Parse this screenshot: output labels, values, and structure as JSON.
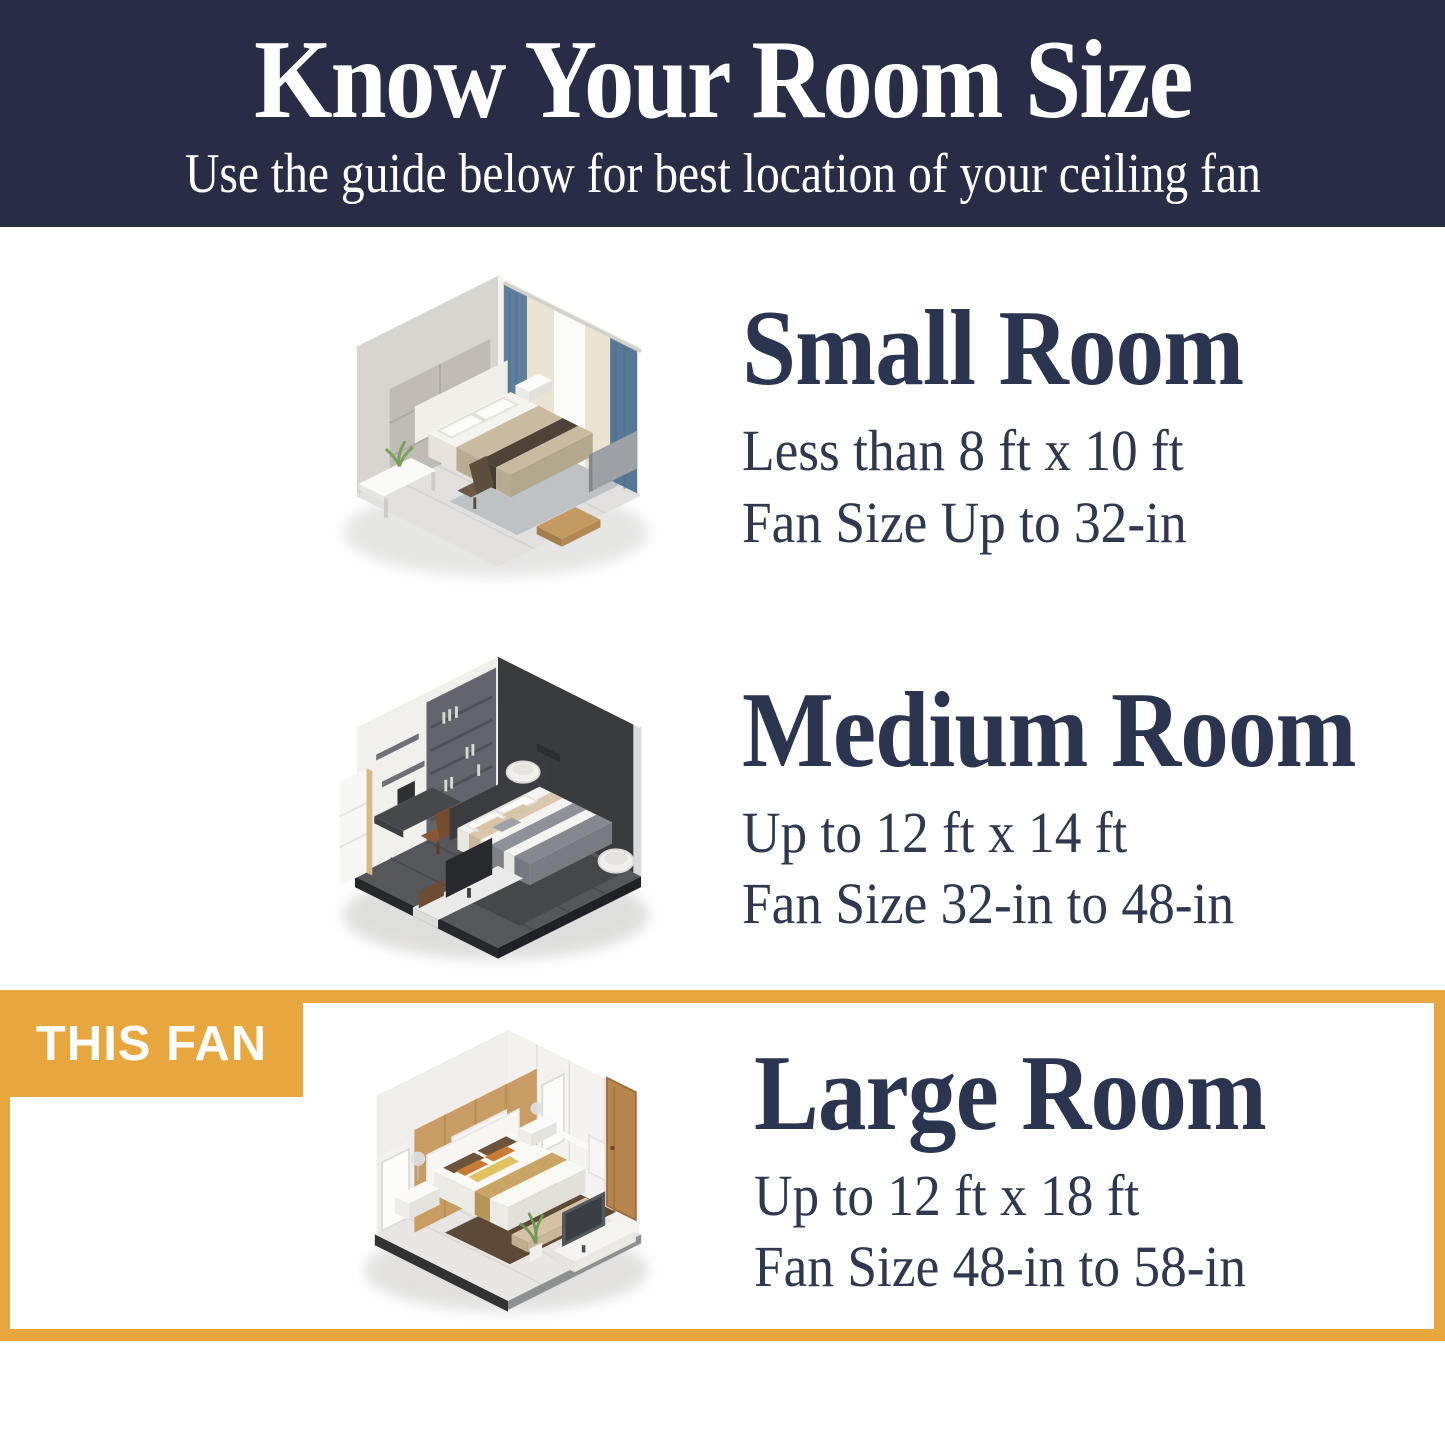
{
  "header": {
    "title": "Know Your Room Size",
    "subtitle": "Use the guide below for best location of your ceiling fan"
  },
  "sections": [
    {
      "name": "Small Room",
      "size_range": "Less than 8 ft x 10 ft",
      "fan_size": "Fan Size Up to 32-in",
      "illustration": "small-bedroom-isometric-view"
    },
    {
      "name": "Medium Room",
      "size_range": "Up to 12 ft x 14 ft",
      "fan_size": "Fan Size 32-in to 48-in",
      "illustration": "medium-bedroom-isometric-view"
    },
    {
      "name": "Large Room",
      "size_range": "Up to 12 ft x 18 ft",
      "fan_size": "Fan Size 48-in to 58-in",
      "illustration": "large-bedroom-isometric-view",
      "highlight_label": "THIS FAN"
    }
  ],
  "colors": {
    "header_bg": "#272d45",
    "header_text": "#ffffff",
    "heading_text": "#2b3550",
    "body_text": "#2e3950",
    "accent_gold": "#e8a73e"
  }
}
